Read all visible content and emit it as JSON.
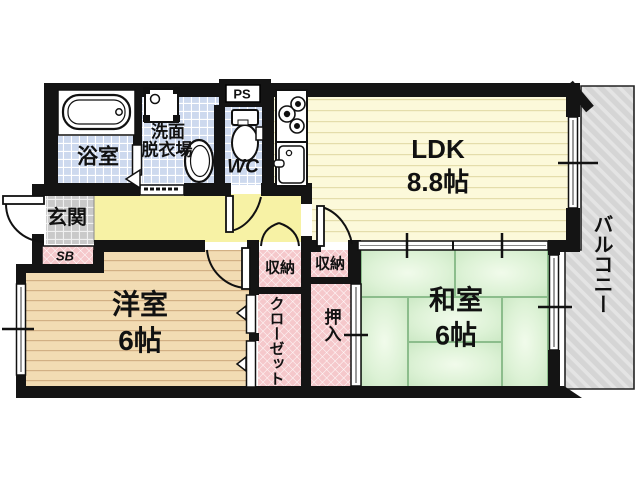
{
  "floorplan": {
    "rooms": {
      "ldk": {
        "name": "LDK",
        "size": "8.8帖"
      },
      "western_room": {
        "name": "洋室",
        "size": "6帖"
      },
      "japanese_room": {
        "name": "和室",
        "size": "6帖"
      },
      "bathroom": {
        "name": "浴室"
      },
      "washroom": {
        "name_line1": "洗面",
        "name_line2": "脱衣場"
      },
      "toilet": {
        "name": "WC"
      },
      "pipe_space": {
        "name": "PS"
      },
      "entrance": {
        "name": "玄関"
      },
      "shoe_box": {
        "name": "SB"
      },
      "storage_left": {
        "name": "収納"
      },
      "storage_right": {
        "name": "収納"
      },
      "closet": {
        "name": "クローゼット"
      },
      "oshiire": {
        "name": "押入"
      },
      "balcony": {
        "name": "バルコニー"
      }
    },
    "fixtures": [
      "bathtub-icon",
      "washing-machine-icon",
      "wash-basin-icon",
      "toilet-icon",
      "gas-stove-icon",
      "kitchen-sink-icon"
    ],
    "colors": {
      "wall": "#141414",
      "hall_yellow": "#f7f2a5",
      "ldk_cream": "#fcf9da",
      "flooring_tan": "#f2dcb3",
      "tatami_green": "#ddf2d6",
      "tile_blue": "#cdd9ee",
      "entrance_gray": "#cbcbcb",
      "closet_pink": "#f5c8cb",
      "balcony_gray": "#d5d5d5"
    }
  }
}
